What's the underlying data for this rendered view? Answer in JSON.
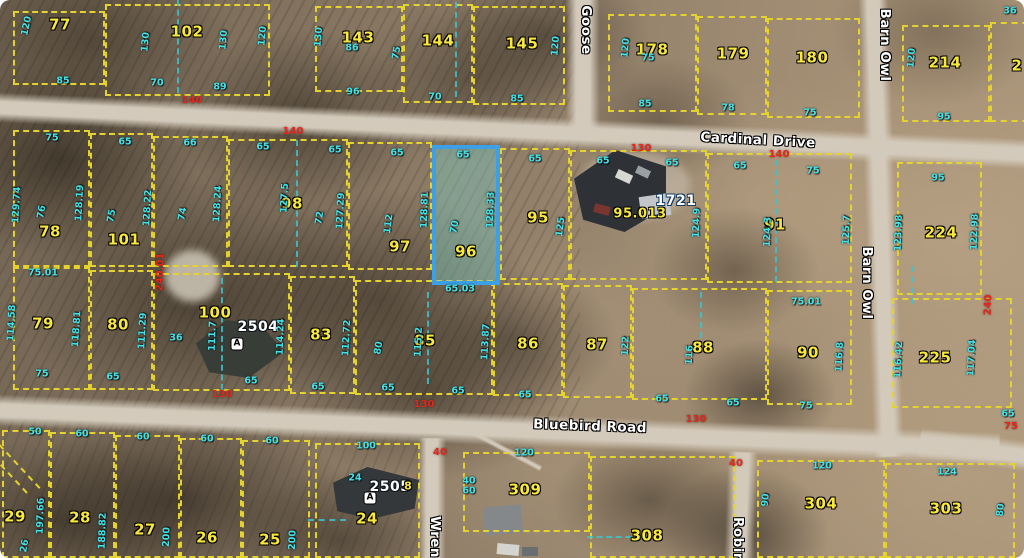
{
  "map": {
    "description": "Aerial parcel (plat) map with lot lines, lot numbers, dimensions and street names; lot 96 highlighted in blue",
    "highlight_color": "#3d9fe6",
    "parcel_line_color": "#e4d22e",
    "dim_color_cyan": "#3fe3e9",
    "dim_color_red": "#e8251a",
    "roads": [
      "Cardinal Drive",
      "Bluebird Road",
      "Goose",
      "Barn Owl",
      "Wren",
      "Robin"
    ],
    "highlighted_parcel": "96",
    "parcels": [
      {
        "num": "77",
        "x": 13,
        "y": 11,
        "w": 92,
        "h": 74,
        "lx": 60,
        "ly": 25
      },
      {
        "num": "102",
        "x": 105,
        "y": 4,
        "w": 165,
        "h": 92,
        "lx": 187,
        "ly": 32
      },
      {
        "num": "143",
        "x": 315,
        "y": 6,
        "w": 88,
        "h": 86,
        "lx": 358,
        "ly": 38
      },
      {
        "num": "144",
        "x": 403,
        "y": 4,
        "w": 70,
        "h": 99,
        "lx": 438,
        "ly": 41
      },
      {
        "num": "145",
        "x": 473,
        "y": 6,
        "w": 92,
        "h": 99,
        "lx": 522,
        "ly": 44
      },
      {
        "num": "178",
        "x": 608,
        "y": 14,
        "w": 89,
        "h": 98,
        "lx": 652,
        "ly": 50
      },
      {
        "num": "179",
        "x": 697,
        "y": 16,
        "w": 70,
        "h": 99,
        "lx": 733,
        "ly": 54
      },
      {
        "num": "180",
        "x": 767,
        "y": 18,
        "w": 93,
        "h": 100,
        "lx": 812,
        "ly": 58
      },
      {
        "num": "214",
        "x": 902,
        "y": 25,
        "w": 88,
        "h": 97,
        "lx": 945,
        "ly": 63
      },
      {
        "num": "2",
        "x": 990,
        "y": 22,
        "w": 60,
        "h": 100,
        "lx": 1017,
        "ly": 66
      },
      {
        "num": "78",
        "x": 13,
        "y": 130,
        "w": 77,
        "h": 137,
        "lx": 50,
        "ly": 232
      },
      {
        "num": "101",
        "x": 90,
        "y": 133,
        "w": 63,
        "h": 134,
        "lx": 124,
        "ly": 240
      },
      {
        "num": "",
        "x": 153,
        "y": 136,
        "w": 75,
        "h": 131,
        "lx": 0,
        "ly": 0
      },
      {
        "num": "98",
        "x": 228,
        "y": 139,
        "w": 120,
        "h": 128,
        "lx": 292,
        "ly": 204
      },
      {
        "num": "97",
        "x": 348,
        "y": 142,
        "w": 84,
        "h": 128,
        "lx": 400,
        "ly": 247
      },
      {
        "num": "96",
        "x": 432,
        "y": 145,
        "w": 68,
        "h": 140,
        "lx": 466,
        "ly": 252,
        "hl": true
      },
      {
        "num": "95",
        "x": 500,
        "y": 148,
        "w": 70,
        "h": 132,
        "lx": 538,
        "ly": 218
      },
      {
        "num": "",
        "x": 570,
        "y": 150,
        "w": 137,
        "h": 130,
        "lx": 0,
        "ly": 0
      },
      {
        "num": "91",
        "x": 707,
        "y": 153,
        "w": 145,
        "h": 130,
        "lx": 775,
        "ly": 225
      },
      {
        "num": "224",
        "x": 897,
        "y": 162,
        "w": 85,
        "h": 133,
        "lx": 941,
        "ly": 233
      },
      {
        "num": "79",
        "x": 13,
        "y": 267,
        "w": 77,
        "h": 123,
        "lx": 43,
        "ly": 324
      },
      {
        "num": "80",
        "x": 90,
        "y": 270,
        "w": 63,
        "h": 120,
        "lx": 118,
        "ly": 325
      },
      {
        "num": "100",
        "x": 153,
        "y": 273,
        "w": 137,
        "h": 118,
        "lx": 215,
        "ly": 313
      },
      {
        "num": "83",
        "x": 290,
        "y": 276,
        "w": 65,
        "h": 118,
        "lx": 321,
        "ly": 335
      },
      {
        "num": "85",
        "x": 355,
        "y": 280,
        "w": 138,
        "h": 115,
        "lx": 425,
        "ly": 341
      },
      {
        "num": "86",
        "x": 493,
        "y": 283,
        "w": 70,
        "h": 113,
        "lx": 528,
        "ly": 344
      },
      {
        "num": "87",
        "x": 563,
        "y": 285,
        "w": 69,
        "h": 113,
        "lx": 597,
        "ly": 345
      },
      {
        "num": "88",
        "x": 632,
        "y": 288,
        "w": 135,
        "h": 112,
        "lx": 703,
        "ly": 348
      },
      {
        "num": "90",
        "x": 767,
        "y": 290,
        "w": 85,
        "h": 115,
        "lx": 808,
        "ly": 353
      },
      {
        "num": "225",
        "x": 892,
        "y": 298,
        "w": 120,
        "h": 110,
        "lx": 935,
        "ly": 358
      },
      {
        "num": "29",
        "x": 2,
        "y": 430,
        "w": 48,
        "h": 128,
        "lx": 15,
        "ly": 517
      },
      {
        "num": "28",
        "x": 50,
        "y": 432,
        "w": 65,
        "h": 126,
        "lx": 80,
        "ly": 518
      },
      {
        "num": "27",
        "x": 115,
        "y": 435,
        "w": 65,
        "h": 123,
        "lx": 145,
        "ly": 530
      },
      {
        "num": "26",
        "x": 180,
        "y": 438,
        "w": 62,
        "h": 120,
        "lx": 207,
        "ly": 538
      },
      {
        "num": "25",
        "x": 242,
        "y": 440,
        "w": 68,
        "h": 118,
        "lx": 270,
        "ly": 540
      },
      {
        "num": "24",
        "x": 315,
        "y": 443,
        "w": 105,
        "h": 115,
        "lx": 367,
        "ly": 519
      },
      {
        "num": "309",
        "x": 463,
        "y": 452,
        "w": 127,
        "h": 80,
        "lx": 525,
        "ly": 490
      },
      {
        "num": "308",
        "x": 590,
        "y": 456,
        "w": 145,
        "h": 102,
        "lx": 647,
        "ly": 536
      },
      {
        "num": "304",
        "x": 757,
        "y": 460,
        "w": 128,
        "h": 98,
        "lx": 821,
        "ly": 504
      },
      {
        "num": "303",
        "x": 885,
        "y": 463,
        "w": 130,
        "h": 95,
        "lx": 946,
        "ly": 509
      }
    ],
    "labels": [
      {
        "t": "Cardinal Drive",
        "x": 758,
        "y": 141,
        "cls": "roadlbl",
        "r": 3,
        "n": "road-label-cardinal-drive"
      },
      {
        "t": "Bluebird Road",
        "x": 590,
        "y": 427,
        "cls": "roadlbl",
        "r": 2,
        "n": "road-label-bluebird-road"
      },
      {
        "t": "Barn Owl",
        "x": 884,
        "y": 45,
        "cls": "roadlbl",
        "r": 90,
        "n": "road-label-barn-owl-top"
      },
      {
        "t": "Barn Owl",
        "x": 866,
        "y": 283,
        "cls": "roadlbl",
        "r": 90,
        "n": "road-label-barn-owl"
      },
      {
        "t": "Goose",
        "x": 585,
        "y": 30,
        "cls": "roadlbl",
        "r": 90,
        "n": "road-label-goose"
      },
      {
        "t": "Wren",
        "x": 434,
        "y": 537,
        "cls": "roadlbl",
        "r": 90,
        "n": "road-label-wren"
      },
      {
        "t": "Robin",
        "x": 737,
        "y": 540,
        "cls": "roadlbl",
        "r": 90,
        "n": "road-label-robin"
      },
      {
        "t": "1721",
        "x": 676,
        "y": 201,
        "cls": "pw pwb",
        "n": "house-number-1721"
      },
      {
        "t": "2504",
        "x": 258,
        "y": 327,
        "cls": "pw",
        "n": "house-number-2504"
      },
      {
        "t": "2505",
        "x": 390,
        "y": 487,
        "cls": "pw",
        "n": "house-number-2505"
      },
      {
        "t": "95.013",
        "x": 640,
        "y": 214,
        "cls": "py",
        "fs": 13,
        "n": "parcel-label-95-013"
      },
      {
        "t": "A",
        "x": 237,
        "y": 344,
        "cls": "aicon",
        "n": "house-symbol-a"
      },
      {
        "t": "A",
        "x": 370,
        "y": 498,
        "cls": "aicon",
        "n": "house-symbol-a"
      },
      {
        "t": "120",
        "x": 27,
        "y": 26,
        "r": -78
      },
      {
        "t": "85",
        "x": 63,
        "y": 81
      },
      {
        "t": "130",
        "x": 146,
        "y": 42,
        "r": -85
      },
      {
        "t": "130",
        "x": 224,
        "y": 40,
        "r": -85
      },
      {
        "t": "120",
        "x": 263,
        "y": 36,
        "r": -85
      },
      {
        "t": "70",
        "x": 157,
        "y": 83
      },
      {
        "t": "89",
        "x": 220,
        "y": 87
      },
      {
        "t": "130",
        "x": 319,
        "y": 37,
        "r": -85
      },
      {
        "t": "86",
        "x": 352,
        "y": 48
      },
      {
        "t": "96",
        "x": 353,
        "y": 92
      },
      {
        "t": "75",
        "x": 397,
        "y": 53,
        "r": -80
      },
      {
        "t": "70",
        "x": 435,
        "y": 97
      },
      {
        "t": "120",
        "x": 556,
        "y": 46,
        "r": -85
      },
      {
        "t": "85",
        "x": 517,
        "y": 99
      },
      {
        "t": "120",
        "x": 626,
        "y": 48,
        "r": -85
      },
      {
        "t": "75",
        "x": 648,
        "y": 58
      },
      {
        "t": "85",
        "x": 645,
        "y": 104
      },
      {
        "t": "78",
        "x": 728,
        "y": 108
      },
      {
        "t": "75",
        "x": 810,
        "y": 113
      },
      {
        "t": "120",
        "x": 912,
        "y": 58,
        "r": -85
      },
      {
        "t": "95",
        "x": 944,
        "y": 117
      },
      {
        "t": "36",
        "x": 1010,
        "y": 11
      },
      {
        "t": "140",
        "x": 192,
        "y": 101,
        "cls": "red"
      },
      {
        "t": "140",
        "x": 293,
        "y": 132,
        "cls": "red"
      },
      {
        "t": "130",
        "x": 641,
        "y": 149,
        "cls": "red"
      },
      {
        "t": "140",
        "x": 779,
        "y": 155,
        "cls": "red"
      },
      {
        "t": "75",
        "x": 52,
        "y": 138
      },
      {
        "t": "129.74",
        "x": 17,
        "y": 205,
        "r": -87
      },
      {
        "t": "76",
        "x": 42,
        "y": 212,
        "r": -80
      },
      {
        "t": "128.19",
        "x": 80,
        "y": 203,
        "r": -87
      },
      {
        "t": "75.01",
        "x": 43,
        "y": 273
      },
      {
        "t": "65",
        "x": 125,
        "y": 142
      },
      {
        "t": "75",
        "x": 112,
        "y": 216,
        "r": -80
      },
      {
        "t": "128.22",
        "x": 148,
        "y": 208,
        "r": -87
      },
      {
        "t": "240.01",
        "x": 161,
        "y": 272,
        "r": -88,
        "cls": "red"
      },
      {
        "t": "66",
        "x": 190,
        "y": 143
      },
      {
        "t": "74",
        "x": 183,
        "y": 214,
        "r": -80
      },
      {
        "t": "128.24",
        "x": 218,
        "y": 204,
        "r": -87
      },
      {
        "t": "65",
        "x": 263,
        "y": 147
      },
      {
        "t": "127.5",
        "x": 285,
        "y": 198,
        "r": -87
      },
      {
        "t": "72",
        "x": 320,
        "y": 218,
        "r": -80
      },
      {
        "t": "65",
        "x": 335,
        "y": 150
      },
      {
        "t": "127.29",
        "x": 341,
        "y": 211,
        "r": -87
      },
      {
        "t": "112",
        "x": 389,
        "y": 224,
        "r": -82
      },
      {
        "t": "65",
        "x": 397,
        "y": 153
      },
      {
        "t": "65",
        "x": 463,
        "y": 155
      },
      {
        "t": "128.81",
        "x": 425,
        "y": 210,
        "r": -88
      },
      {
        "t": "70",
        "x": 455,
        "y": 227,
        "r": -80
      },
      {
        "t": "128.33",
        "x": 491,
        "y": 210,
        "r": -88
      },
      {
        "t": "65.03",
        "x": 460,
        "y": 289
      },
      {
        "t": "65",
        "x": 535,
        "y": 159
      },
      {
        "t": "125",
        "x": 561,
        "y": 227,
        "r": -83
      },
      {
        "t": "65",
        "x": 603,
        "y": 161
      },
      {
        "t": "65",
        "x": 672,
        "y": 163
      },
      {
        "t": "124.9",
        "x": 697,
        "y": 223,
        "r": -88
      },
      {
        "t": "65",
        "x": 740,
        "y": 166
      },
      {
        "t": "75",
        "x": 813,
        "y": 171
      },
      {
        "t": "124.3",
        "x": 768,
        "y": 232,
        "r": -88
      },
      {
        "t": "125.7",
        "x": 847,
        "y": 230,
        "r": -88
      },
      {
        "t": "95",
        "x": 938,
        "y": 178
      },
      {
        "t": "123.98",
        "x": 899,
        "y": 233,
        "r": -88
      },
      {
        "t": "122.98",
        "x": 975,
        "y": 232,
        "r": -88
      },
      {
        "t": "114.58",
        "x": 12,
        "y": 323,
        "r": -87
      },
      {
        "t": "118.81",
        "x": 77,
        "y": 329,
        "r": -86
      },
      {
        "t": "75",
        "x": 42,
        "y": 374
      },
      {
        "t": "111.29",
        "x": 143,
        "y": 331,
        "r": -87
      },
      {
        "t": "65",
        "x": 113,
        "y": 377
      },
      {
        "t": "111.7",
        "x": 213,
        "y": 336,
        "r": -88
      },
      {
        "t": "36",
        "x": 176,
        "y": 338
      },
      {
        "t": "114.24",
        "x": 281,
        "y": 337,
        "r": -88
      },
      {
        "t": "65",
        "x": 251,
        "y": 381
      },
      {
        "t": "65",
        "x": 318,
        "y": 387
      },
      {
        "t": "112.72",
        "x": 347,
        "y": 338,
        "r": -87
      },
      {
        "t": "80",
        "x": 379,
        "y": 348,
        "r": -80
      },
      {
        "t": "115.2",
        "x": 419,
        "y": 342,
        "r": -87
      },
      {
        "t": "65",
        "x": 388,
        "y": 388
      },
      {
        "t": "65",
        "x": 458,
        "y": 391
      },
      {
        "t": "113.87",
        "x": 486,
        "y": 342,
        "r": -87
      },
      {
        "t": "65",
        "x": 525,
        "y": 395
      },
      {
        "t": "122",
        "x": 626,
        "y": 346,
        "r": -87
      },
      {
        "t": "116",
        "x": 690,
        "y": 355,
        "r": -87
      },
      {
        "t": "65",
        "x": 662,
        "y": 399
      },
      {
        "t": "65",
        "x": 733,
        "y": 403
      },
      {
        "t": "75.01",
        "x": 806,
        "y": 302
      },
      {
        "t": "116.8",
        "x": 840,
        "y": 357,
        "r": -87
      },
      {
        "t": "75",
        "x": 806,
        "y": 406
      },
      {
        "t": "116.42",
        "x": 899,
        "y": 360,
        "r": -87
      },
      {
        "t": "117.04",
        "x": 972,
        "y": 358,
        "r": -87
      },
      {
        "t": "65",
        "x": 1008,
        "y": 414
      },
      {
        "t": "130",
        "x": 222,
        "y": 395,
        "cls": "red"
      },
      {
        "t": "130",
        "x": 424,
        "y": 405,
        "cls": "red"
      },
      {
        "t": "130",
        "x": 696,
        "y": 420,
        "cls": "red"
      },
      {
        "t": "240",
        "x": 989,
        "y": 305,
        "r": -88,
        "cls": "red"
      },
      {
        "t": "75",
        "x": 1011,
        "y": 427,
        "cls": "red"
      },
      {
        "t": "50",
        "x": 35,
        "y": 432
      },
      {
        "t": "60",
        "x": 82,
        "y": 434
      },
      {
        "t": "60",
        "x": 143,
        "y": 437
      },
      {
        "t": "60",
        "x": 207,
        "y": 439
      },
      {
        "t": "60",
        "x": 272,
        "y": 441
      },
      {
        "t": "197.66",
        "x": 41,
        "y": 516,
        "r": -88
      },
      {
        "t": "188.82",
        "x": 103,
        "y": 531,
        "r": -88
      },
      {
        "t": "200",
        "x": 167,
        "y": 537,
        "r": -88
      },
      {
        "t": "200",
        "x": 293,
        "y": 540,
        "r": -88
      },
      {
        "t": "26",
        "x": 25,
        "y": 546,
        "r": -80
      },
      {
        "t": "100",
        "x": 366,
        "y": 446
      },
      {
        "t": "24",
        "x": 355,
        "y": 478
      },
      {
        "t": "8",
        "x": 408,
        "y": 486,
        "cls": "pys"
      },
      {
        "t": "120",
        "x": 524,
        "y": 453
      },
      {
        "t": "40",
        "x": 469,
        "y": 481
      },
      {
        "t": "60",
        "x": 469,
        "y": 491
      },
      {
        "t": "120",
        "x": 822,
        "y": 466
      },
      {
        "t": "90",
        "x": 766,
        "y": 500,
        "r": -85
      },
      {
        "t": "124",
        "x": 947,
        "y": 472
      },
      {
        "t": "80",
        "x": 1001,
        "y": 510,
        "r": -85
      },
      {
        "t": "40",
        "x": 440,
        "y": 453,
        "cls": "red"
      },
      {
        "t": "40",
        "x": 736,
        "y": 464,
        "cls": "red"
      }
    ],
    "utility_lines": [
      {
        "o": "v",
        "x": 177,
        "y": 0,
        "len": 93
      },
      {
        "o": "v",
        "x": 455,
        "y": 2,
        "len": 95
      },
      {
        "o": "v",
        "x": 296,
        "y": 140,
        "len": 127
      },
      {
        "o": "v",
        "x": 221,
        "y": 278,
        "len": 112
      },
      {
        "o": "v",
        "x": 427,
        "y": 292,
        "len": 92
      },
      {
        "o": "v",
        "x": 700,
        "y": 292,
        "len": 56
      },
      {
        "o": "v",
        "x": 775,
        "y": 160,
        "len": 122
      },
      {
        "o": "v",
        "x": 911,
        "y": 266,
        "len": 38
      },
      {
        "o": "h",
        "x": 308,
        "y": 519,
        "len": 38
      },
      {
        "o": "h",
        "x": 587,
        "y": 536,
        "len": 73
      }
    ]
  }
}
